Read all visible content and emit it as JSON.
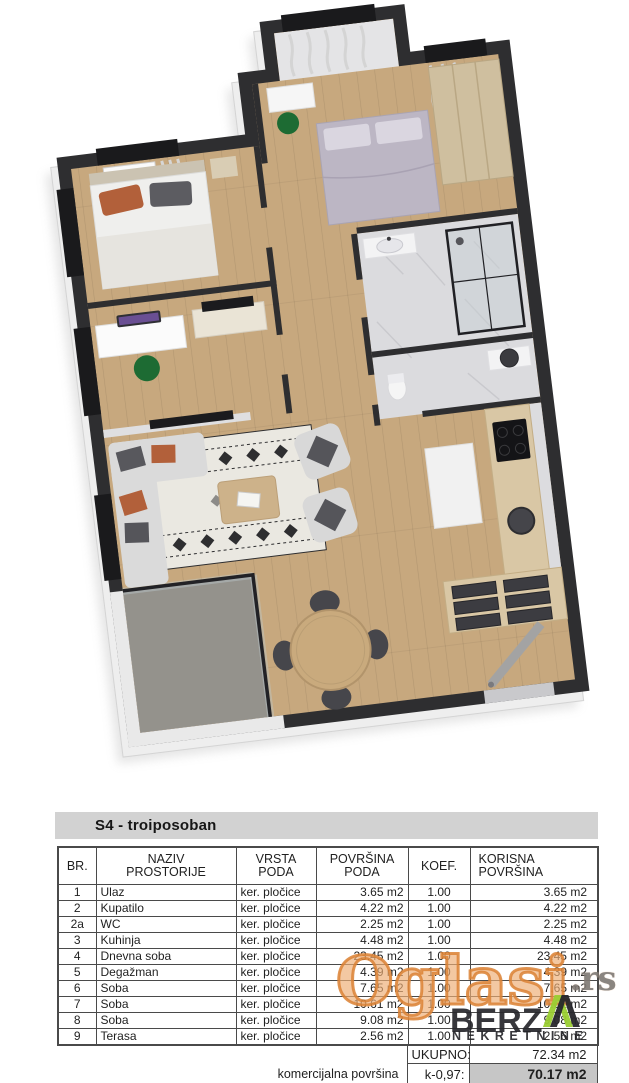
{
  "listing": {
    "title": "S4 - troiposoban"
  },
  "table": {
    "headers": {
      "br": "BR.",
      "naziv": "NAZIV\nPROSTORIJE",
      "vrsta": "VRSTA\nPODA",
      "povrsina": "POVRŠINA\nPODA",
      "koef": "KOEF.",
      "korisna": "KORISNA\nPOVRŠINA"
    },
    "rows": [
      {
        "br": "1",
        "naziv": "Ulaz",
        "vrsta": "ker. pločice",
        "povrsina": "3.65 m2",
        "koef": "1.00",
        "korisna": "3.65 m2"
      },
      {
        "br": "2",
        "naziv": "Kupatilo",
        "vrsta": "ker. pločice",
        "povrsina": "4.22 m2",
        "koef": "1.00",
        "korisna": "4.22 m2"
      },
      {
        "br": "2a",
        "naziv": "WC",
        "vrsta": "ker. pločice",
        "povrsina": "2.25 m2",
        "koef": "1.00",
        "korisna": "2.25 m2"
      },
      {
        "br": "3",
        "naziv": "Kuhinja",
        "vrsta": "ker. pločice",
        "povrsina": "4.48 m2",
        "koef": "1.00",
        "korisna": "4.48 m2"
      },
      {
        "br": "4",
        "naziv": "Dnevna soba",
        "vrsta": "ker. pločice",
        "povrsina": "23.45 m2",
        "koef": "1.00",
        "korisna": "23.45 m2"
      },
      {
        "br": "5",
        "naziv": "Degažman",
        "vrsta": "ker. pločice",
        "povrsina": "4.39 m2",
        "koef": "1.00",
        "korisna": "4.39 m2"
      },
      {
        "br": "6",
        "naziv": "Soba",
        "vrsta": "ker. pločice",
        "povrsina": "7.65 m2",
        "koef": "1.00",
        "korisna": "7.65 m2"
      },
      {
        "br": "7",
        "naziv": "Soba",
        "vrsta": "ker. pločice",
        "povrsina": "10.61 m2",
        "koef": "1.00",
        "korisna": "10.61 m2"
      },
      {
        "br": "8",
        "naziv": "Soba",
        "vrsta": "ker. pločice",
        "povrsina": "9.08 m2",
        "koef": "1.00",
        "korisna": "9.08 m2"
      },
      {
        "br": "9",
        "naziv": "Terasa",
        "vrsta": "ker. pločice",
        "povrsina": "2.56 m2",
        "koef": "1.00",
        "korisna": "2.56 m2"
      }
    ],
    "totals": {
      "ukupno_label": "UKUPNO:",
      "ukupno_value": "72.34 m2",
      "komercijalna_label": "komercijalna površina",
      "koef_label": "k-0,97:",
      "komercijalna_value": "70.17 m2"
    }
  },
  "watermark": {
    "brand": "Oglasi",
    "tld": ".rs",
    "agency": "BERZ",
    "agency_a": "Λ",
    "agency_sub": "NEKRETNINE",
    "brand_color": "#db8134",
    "agency_color": "#26262b",
    "accent_green": "#9acd32"
  },
  "floorplan": {
    "type": "3d-floor-plan-top-view",
    "colors": {
      "wall": "#2e2e30",
      "wall_face": "#eeeeee",
      "wood_floor": "#c7a87e",
      "terrace_floor": "#94928c",
      "marble": "#dbdbde",
      "counter_wood": "#d9c7a5",
      "sofa": "#d9d9d9",
      "pillow_rust": "#b2603a",
      "chair_green": "#1d6b33",
      "drawer_dark": "#3c3c41"
    }
  }
}
